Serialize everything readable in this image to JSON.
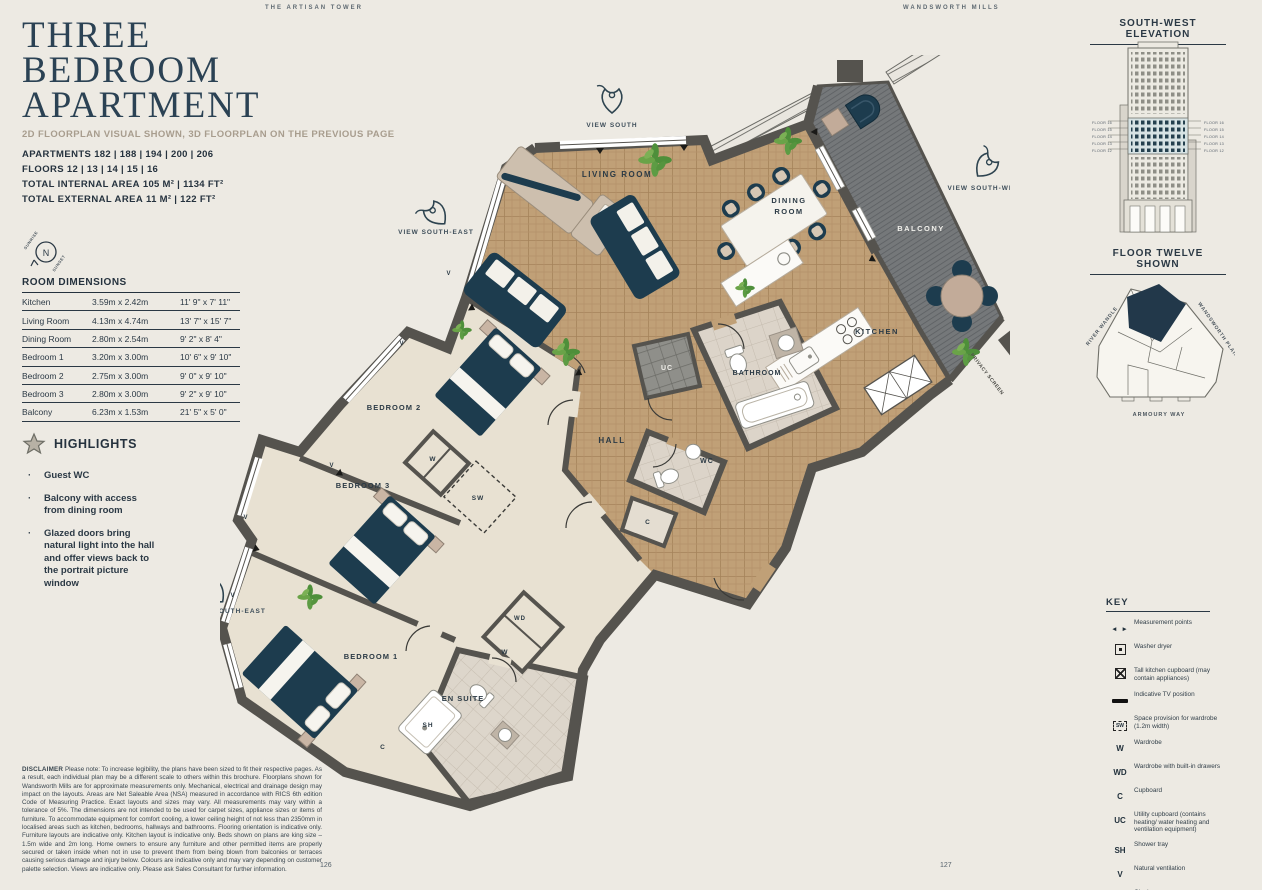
{
  "header": {
    "brand_left": "THE ARTISAN TOWER",
    "brand_right": "WANDSWORTH MILLS"
  },
  "title": {
    "line1": "THREE",
    "line2": "BEDROOM",
    "line3": "APARTMENT"
  },
  "subtitle": "2D FLOORPLAN VISUAL SHOWN, 3D FLOORPLAN ON THE PREVIOUS PAGE",
  "info": [
    {
      "label": "APARTMENTS",
      "value": "182 | 188 | 194 | 200 | 206"
    },
    {
      "label": "FLOORS",
      "value": "12 | 13 | 14 | 15 | 16"
    },
    {
      "label": "TOTAL INTERNAL AREA",
      "value": "105 M² | 1134 FT²"
    },
    {
      "label": "TOTAL EXTERNAL AREA",
      "value": "11 M² | 122 FT²"
    }
  ],
  "compass": {
    "labels": [
      {
        "t": "N",
        "x": 46,
        "y": 256,
        "s": 9,
        "w": 400,
        "ls": 0,
        "c": "#2b3945"
      },
      {
        "t": "SUNRISE",
        "x": 32,
        "y": 241,
        "s": 4,
        "r": -55,
        "ls": 0.5,
        "w": 600,
        "c": "#4a555e"
      },
      {
        "t": "SUNSET",
        "x": 60,
        "y": 264,
        "s": 4,
        "r": -55,
        "ls": 0.5,
        "w": 600,
        "c": "#4a555e"
      }
    ]
  },
  "dimensions": {
    "heading": "ROOM DIMENSIONS",
    "rows": [
      [
        "Kitchen",
        "3.59m x 2.42m",
        "11' 9\" x 7' 11\""
      ],
      [
        "Living Room",
        "4.13m x 4.74m",
        "13' 7\" x 15' 7\""
      ],
      [
        "Dining Room",
        "2.80m x 2.54m",
        "9' 2\" x 8' 4\""
      ],
      [
        "Bedroom 1",
        "3.20m x 3.00m",
        "10' 6\" x 9' 10\""
      ],
      [
        "Bedroom 2",
        "2.75m x 3.00m",
        "9' 0\" x 9' 10\""
      ],
      [
        "Bedroom 3",
        "2.80m x 3.00m",
        "9' 2\" x 9' 10\""
      ],
      [
        "Balcony",
        "6.23m x 1.53m",
        "21' 5\" x 5' 0\""
      ]
    ]
  },
  "highlights": {
    "heading": "HIGHLIGHTS",
    "items": [
      "Guest WC",
      "Balcony with access from dining room",
      "Glazed doors bring natural light into the hall and offer views back to the portrait picture window"
    ]
  },
  "disclaimer": {
    "label": "DISCLAIMER",
    "text": " Please note: To increase legibility, the plans have been sized to fit their respective pages. As a result, each individual plan may be a different scale to others within this brochure. Floorplans shown for Wandsworth Mills are for approximate measurements only. Mechanical, electrical and drainage design may impact on the layouts. Areas are Net Saleable Area (NSA) measured in accordance with RICS 6th edition Code of Measuring Practice. Exact layouts and sizes may vary. All measurements may vary within a tolerance of 5%. The dimensions are not intended to be used for carpet sizes, appliance sizes or items of furniture. To accommodate equipment for comfort cooling, a lower ceiling height of not less than 2350mm in localised areas such as kitchen, bedrooms, hallways and bathrooms. Flooring orientation is indicative only. Furniture layouts are indicative only. Kitchen layout is indicative only. Beds shown on plans are king size – 1.5m wide and 2m long. Home owners to ensure any furniture and other permitted items are properly secured or taken inside when not in use to prevent them from being blown from balconies or terraces causing serious damage and injury below. Colours are indicative only and may vary depending on customer palette selection. Views are indicative only. Please ask Sales Consultant for further information."
  },
  "pages": {
    "left": "126",
    "right": "127"
  },
  "elevation": {
    "heading": "SOUTH-WEST ELEVATION",
    "caption": "FLOOR TWELVE SHOWN",
    "labels": [
      {
        "t": "FLOOR 16",
        "x": 1112,
        "y": 124,
        "s": 3.8,
        "a": "end",
        "w": 400,
        "ls": 0.2,
        "c": "#5a646e"
      },
      {
        "t": "FLOOR 15",
        "x": 1112,
        "y": 131,
        "s": 3.8,
        "a": "end",
        "w": 400,
        "ls": 0.2,
        "c": "#5a646e"
      },
      {
        "t": "FLOOR 14",
        "x": 1112,
        "y": 138,
        "s": 3.8,
        "a": "end",
        "w": 400,
        "ls": 0.2,
        "c": "#5a646e"
      },
      {
        "t": "FLOOR 13",
        "x": 1112,
        "y": 145,
        "s": 3.8,
        "a": "end",
        "w": 400,
        "ls": 0.2,
        "c": "#5a646e"
      },
      {
        "t": "FLOOR 12",
        "x": 1112,
        "y": 152,
        "s": 3.8,
        "a": "end",
        "w": 400,
        "ls": 0.2,
        "c": "#5a646e"
      },
      {
        "t": "FLOOR 16",
        "x": 1204,
        "y": 124,
        "s": 3.8,
        "a": "start",
        "w": 400,
        "ls": 0.2,
        "c": "#5a646e"
      },
      {
        "t": "FLOOR 15",
        "x": 1204,
        "y": 131,
        "s": 3.8,
        "a": "start",
        "w": 400,
        "ls": 0.2,
        "c": "#5a646e"
      },
      {
        "t": "FLOOR 14",
        "x": 1204,
        "y": 138,
        "s": 3.8,
        "a": "start",
        "w": 400,
        "ls": 0.2,
        "c": "#5a646e"
      },
      {
        "t": "FLOOR 13",
        "x": 1204,
        "y": 145,
        "s": 3.8,
        "a": "start",
        "w": 400,
        "ls": 0.2,
        "c": "#5a646e"
      },
      {
        "t": "FLOOR 12",
        "x": 1204,
        "y": 152,
        "s": 3.8,
        "a": "start",
        "w": 400,
        "ls": 0.2,
        "c": "#5a646e"
      }
    ]
  },
  "siteplan": {
    "labels": [
      {
        "t": "RIVER WANDLE",
        "x": 1103,
        "y": 327,
        "r": -52,
        "s": 5,
        "ls": 0.8,
        "w": 600,
        "c": "#4c565e"
      },
      {
        "t": "WANDSWORTH PLAIN",
        "x": 1217,
        "y": 331,
        "r": 55,
        "s": 5,
        "ls": 0.8,
        "w": 600,
        "c": "#4c565e"
      },
      {
        "t": "ARMOURY WAY",
        "x": 1159,
        "y": 416,
        "s": 5.5,
        "ls": 1,
        "w": 600,
        "c": "#4c565e"
      }
    ]
  },
  "key": {
    "heading": "KEY",
    "items": [
      {
        "sym": "arrows",
        "label": "Measurement points"
      },
      {
        "sym": "washer",
        "label": "Washer dryer"
      },
      {
        "sym": "tall",
        "label": "Tall kitchen cupboard (may contain appliances)"
      },
      {
        "sym": "tv",
        "label": "Indicative TV position"
      },
      {
        "sym": "sw",
        "box": "SW",
        "label": "Space provision for wardrobe (1.2m width)"
      },
      {
        "sym": "W",
        "label": "Wardrobe"
      },
      {
        "sym": "WD",
        "label": "Wardrobe with built-in drawers"
      },
      {
        "sym": "C",
        "label": "Cupboard"
      },
      {
        "sym": "UC",
        "label": "Utility cupboard (contains heating/ water heating and ventilation equipment)"
      },
      {
        "sym": "SH",
        "label": "Shower tray"
      },
      {
        "sym": "V",
        "label": "Natural ventilation"
      },
      {
        "sym": "WC",
        "label": "Cloakroom"
      },
      {
        "sym": "feature",
        "label": "Architectural feature structure"
      }
    ]
  },
  "floorplan": {
    "labels": [
      {
        "t": "LIVING ROOM",
        "x": 617,
        "y": 177,
        "s": 8,
        "ls": 1.5
      },
      {
        "t": "DINING",
        "x": 789,
        "y": 203,
        "s": 7.5,
        "ls": 1.5
      },
      {
        "t": "ROOM",
        "x": 789,
        "y": 214,
        "s": 7.5,
        "ls": 1.5
      },
      {
        "t": "KITCHEN",
        "x": 877,
        "y": 334,
        "s": 7.5,
        "ls": 1.5
      },
      {
        "t": "BALCONY",
        "x": 921,
        "y": 231,
        "s": 7.5,
        "ls": 1.5,
        "c": "#f2f1ec"
      },
      {
        "t": "HALL",
        "x": 612,
        "y": 443,
        "s": 8,
        "ls": 1.5
      },
      {
        "t": "BATHROOM",
        "x": 757,
        "y": 375,
        "s": 7,
        "ls": 1
      },
      {
        "t": "WC",
        "x": 707,
        "y": 463,
        "s": 7
      },
      {
        "t": "UC",
        "x": 667,
        "y": 370,
        "s": 7,
        "c": "#f2f1ec"
      },
      {
        "t": "C",
        "x": 648,
        "y": 524,
        "s": 6.5
      },
      {
        "t": "C",
        "x": 383,
        "y": 749,
        "s": 6.5
      },
      {
        "t": "SW",
        "x": 478,
        "y": 500,
        "s": 6.5
      },
      {
        "t": "W",
        "x": 433,
        "y": 461,
        "s": 6.5
      },
      {
        "t": "W",
        "x": 505,
        "y": 654,
        "s": 6.5
      },
      {
        "t": "WD",
        "x": 520,
        "y": 620,
        "s": 6
      },
      {
        "t": "BEDROOM 2",
        "x": 394,
        "y": 410,
        "s": 7.5,
        "ls": 1
      },
      {
        "t": "BEDROOM 3",
        "x": 363,
        "y": 488,
        "s": 7.5,
        "ls": 1
      },
      {
        "t": "BEDROOM 1",
        "x": 371,
        "y": 659,
        "s": 7.5,
        "ls": 1
      },
      {
        "t": "EN SUITE",
        "x": 463,
        "y": 701,
        "s": 7.5,
        "ls": 1
      },
      {
        "t": "SH",
        "x": 428,
        "y": 727,
        "s": 6.5
      },
      {
        "t": "V",
        "x": 449,
        "y": 275,
        "s": 6
      },
      {
        "t": "V",
        "x": 402,
        "y": 345,
        "s": 6
      },
      {
        "t": "V",
        "x": 332,
        "y": 467,
        "s": 6
      },
      {
        "t": "V",
        "x": 246,
        "y": 519,
        "s": 6
      },
      {
        "t": "V",
        "x": 233,
        "y": 597,
        "s": 6
      },
      {
        "t": "VIEW SOUTH",
        "x": 612,
        "y": 127,
        "s": 6.5,
        "ls": 1,
        "c": "#3e4e5a"
      },
      {
        "t": "VIEW SOUTH-EAST",
        "x": 436,
        "y": 234,
        "s": 6.5,
        "ls": 1,
        "c": "#3e4e5a"
      },
      {
        "t": "VIEW SOUTH-WEST",
        "x": 986,
        "y": 190,
        "s": 6.5,
        "ls": 1,
        "c": "#3e4e5a"
      },
      {
        "t": "VIEW SOUTH-EAST",
        "x": 228,
        "y": 613,
        "s": 6.5,
        "ls": 1,
        "c": "#3e4e5a"
      },
      {
        "t": "PRIVACY SCREEN",
        "x": 986,
        "y": 375,
        "s": 5,
        "r": 52,
        "ls": 0.5,
        "c": "#4c4c47"
      }
    ]
  }
}
